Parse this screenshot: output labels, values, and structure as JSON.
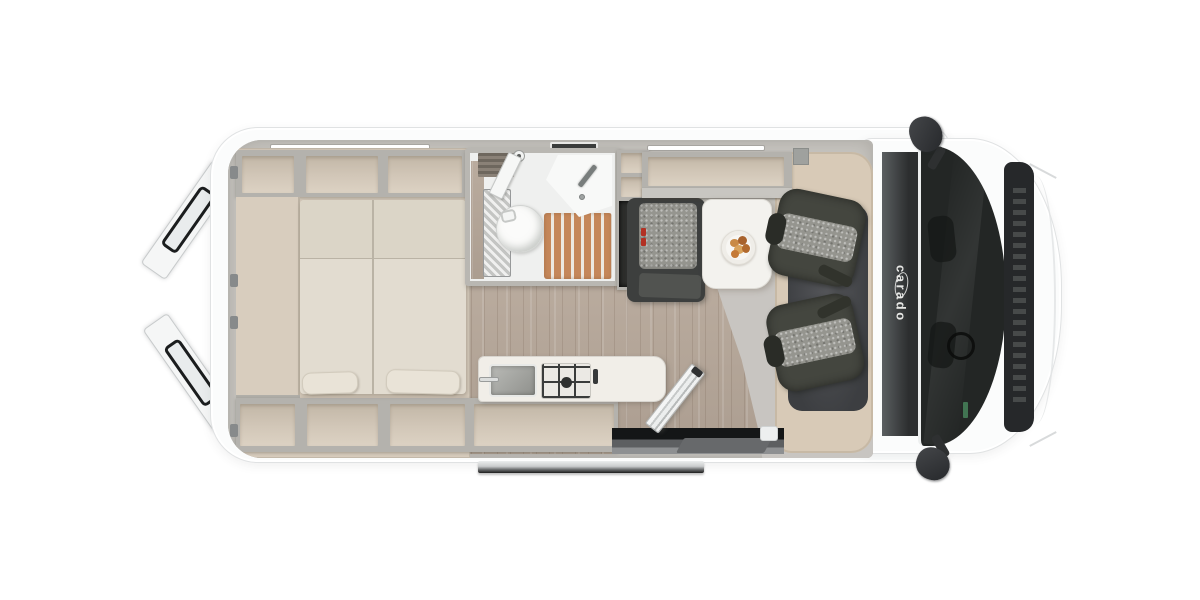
{
  "meta": {
    "title": "Camper van floor plan, top view"
  },
  "brand": {
    "logo_text": "carado"
  },
  "colors": {
    "page_bg": "#ffffff",
    "body_white": "#fbfcfc",
    "body_outline": "#e0e2e3",
    "wall_gray": "#c6c4bf",
    "wall_rim": "#b4b2ad",
    "furniture_beige": "#d6cbbc",
    "compartment_beige": "#d2c7b8",
    "cab_beige": "#d8cab7",
    "mattress": "#e2dcd0",
    "mattress_head": "#dbd5c7",
    "pillow": "#e9e3d7",
    "wood_floor": "#b5a698",
    "cab_floor": "#c8c5c1",
    "bathroom_white": "#eff0ef",
    "shower_slats": "#c5875a",
    "bench_dark": "#3d3f3e",
    "seat_fabric": "#95958f",
    "seat_frame": "#44463f",
    "table_white": "#f3f2ee",
    "band_dark": "#2c2e2f",
    "windshield": "#232625",
    "cowl": "#26282a",
    "step_silver": "#c9cbcc",
    "door_black": "#1b1d1e",
    "buckle_red": "#b23124",
    "logo_white": "#f0f0ee"
  },
  "elements": {
    "inventory": [
      "open-rear-barn-doors",
      "overhead-storage-shelves",
      "double-bed-with-pillows",
      "bathroom-with-toilet-sink-shower",
      "wardrobe",
      "rear-facing-dinette-bench",
      "dinette-table-with-plate",
      "kitchen-with-sink-and-two-burner-hob",
      "open-sliding-entry-door-with-step",
      "two-swivel-cab-seats",
      "windshield-with-wipers",
      "side-mirrors"
    ]
  }
}
